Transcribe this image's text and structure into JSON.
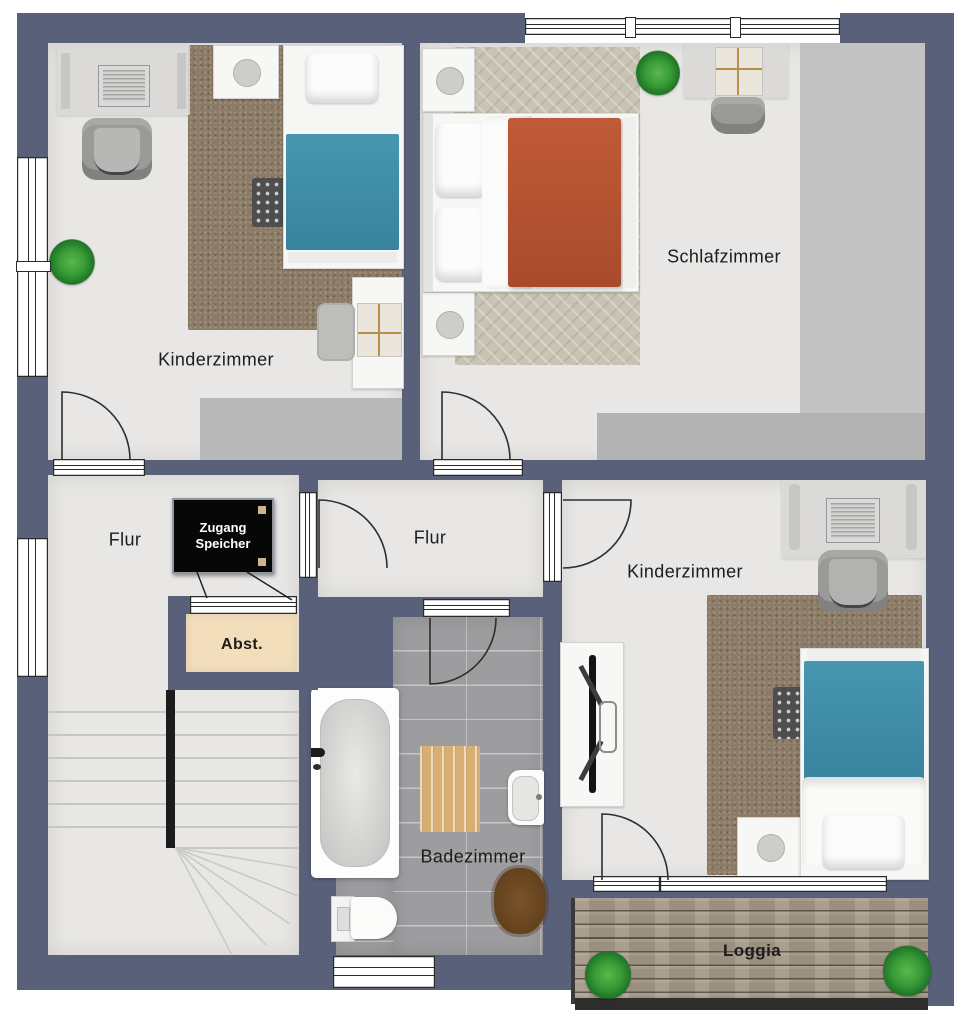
{
  "rooms": [
    {
      "id": "kinderzimmer-left",
      "label": "Kinderzimmer"
    },
    {
      "id": "schlafzimmer",
      "label": "Schlafzimmer"
    },
    {
      "id": "flur-left",
      "label": "Flur"
    },
    {
      "id": "flur-middle",
      "label": "Flur"
    },
    {
      "id": "kinderzimmer-right",
      "label": "Kinderzimmer"
    },
    {
      "id": "badezimmer",
      "label": "Badezimmer"
    },
    {
      "id": "abstellraum",
      "label": "Abst."
    },
    {
      "id": "loggia",
      "label": "Loggia"
    }
  ],
  "attic_sign": {
    "line1": "Zugang",
    "line2": "Speicher"
  },
  "colors": {
    "wall": "#59617a",
    "room_floor": "#e8e7e5",
    "carpet_brown": "#8c7b66",
    "carpet_herringbone": "#c8c3b3",
    "bathroom_tile": "#9d9da0",
    "loggia_wood": "#a59887",
    "abst_fill": "#f2debb",
    "bed_blue": "#3e8ca6",
    "bed_red": "#b75435",
    "closet_gray": "#b9b9b9",
    "sign_bg": "#070707",
    "sign_text": "#ffffff"
  }
}
